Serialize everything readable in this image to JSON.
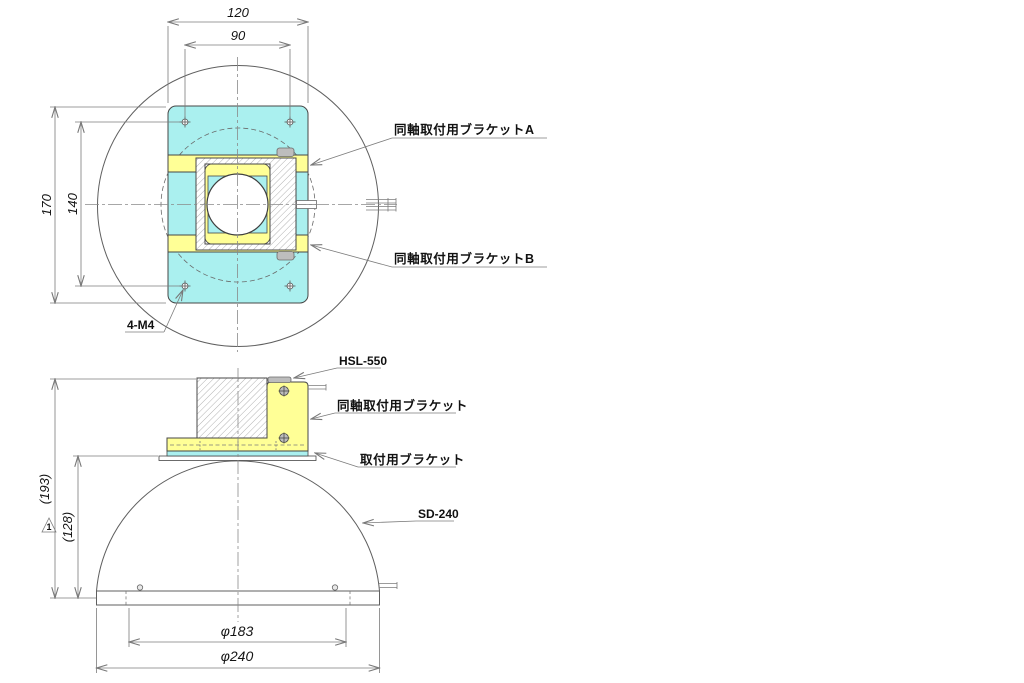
{
  "colors": {
    "cyan": "#aaf0ef",
    "yellow": "#ffff96",
    "gray": "#bdbdbd",
    "white": "#ffffff"
  },
  "top_view": {
    "dim_outer_width": "120",
    "dim_inner_width": "90",
    "dim_outer_height": "170",
    "dim_inner_height": "140",
    "screw_callout": "4-M4",
    "bracket_a_label": "同軸取付用ブラケットA",
    "bracket_b_label": "同軸取付用ブラケットB"
  },
  "side_view": {
    "camera_label": "HSL-550",
    "coax_bracket_label": "同軸取付用ブラケット",
    "mount_bracket_label": "取付用ブラケット",
    "dome_label": "SD-240",
    "dim_total_height": "(193)",
    "dim_dome_height": "(128)",
    "dim_inner_diameter": "φ183",
    "dim_outer_diameter": "φ240",
    "revision_number": "1"
  }
}
